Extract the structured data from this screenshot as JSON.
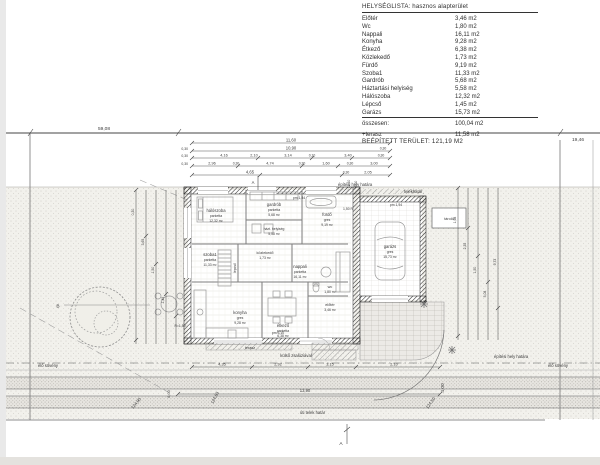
{
  "title_block": {
    "list_title": "HELYSÉGLISTA:  hasznos alapterület",
    "rows": [
      {
        "label": "Előtér",
        "value": "3,46 m2"
      },
      {
        "label": "Wc",
        "value": "1,80 m2"
      },
      {
        "label": "Nappali",
        "value": "16,11 m2"
      },
      {
        "label": "Konyha",
        "value": "9,28 m2"
      },
      {
        "label": "Étkező",
        "value": "6,38 m2"
      },
      {
        "label": "Közlekedő",
        "value": "1,73 m2"
      },
      {
        "label": "Fürdő",
        "value": "9,19 m2"
      },
      {
        "label": "Szoba1",
        "value": "11,33 m2"
      },
      {
        "label": "Gardrób",
        "value": "5,68 m2"
      },
      {
        "label": "Háztartási helyiség",
        "value": "5,58 m2"
      },
      {
        "label": "Hálószoba",
        "value": "12,32 m2"
      },
      {
        "label": "Lépcső",
        "value": "1,45 m2"
      },
      {
        "label": "Garázs",
        "value": "15,73 m2"
      }
    ],
    "total_label": "összesen:",
    "total_value": "100,04 m2",
    "terrace_label": "+terasz",
    "terrace_value": "11,58 m2",
    "built_area": "BEÉPÍTETT TERÜLET: 121,19 M2"
  },
  "rooms": [
    {
      "name": "hálószoba",
      "finish": "parketta",
      "area": "12,32 m²"
    },
    {
      "name": "gardrób",
      "finish": "parketta",
      "area": "5,68 m²"
    },
    {
      "name": "fürdő",
      "finish": "gres",
      "area": "9,19 m²"
    },
    {
      "name": "szoba1",
      "finish": "parketta",
      "area": "11,33 m²"
    },
    {
      "name": "házt. helyiség",
      "finish": "gres",
      "area": "5,58 m²"
    },
    {
      "name": "közlekedő",
      "finish": "parketta",
      "area": "1,73 m²"
    },
    {
      "name": "nappali",
      "finish": "parketta",
      "area": "16,11 m²"
    },
    {
      "name": "konyha",
      "finish": "gres",
      "area": "9,28 m²"
    },
    {
      "name": "étkező",
      "finish": "parketta",
      "area": "6,38 m²"
    },
    {
      "name": "előtér",
      "finish": "gres",
      "area": "3,46 m²"
    },
    {
      "name": "wc",
      "finish": "gres",
      "area": "1,80 m²"
    },
    {
      "name": "garázs",
      "finish": "gres",
      "area": "15,73 m²"
    },
    {
      "name": "terasz"
    },
    {
      "name": "lépcső"
    },
    {
      "name": "tároló"
    }
  ],
  "site_labels": {
    "building_line_top": "építési hely határa",
    "plot_boundary_top": "telekhatár",
    "building_line_right": "építési hely határa",
    "hedge_right": "élő sövény",
    "hedge_left": "élő sövény",
    "street_boundary": "úti telek határ",
    "shutter_note": "külső zsalúziával"
  },
  "dims": {
    "overall_left": "59,08",
    "overall_right": "19,46",
    "top_row1": "11,60",
    "top_row2": [
      "0,30",
      "10,90",
      "0,30"
    ],
    "top_row3": [
      "0,30",
      "4,16",
      "2,10",
      "3,14",
      "0,10",
      "3,40",
      "0,30"
    ],
    "top_row4": [
      "0,30",
      "2,96",
      "0,30",
      "4,74",
      "0,30",
      "1,60",
      "0,30",
      "3,00"
    ],
    "top_row5": [
      "4,65",
      "0,30",
      "2,05"
    ],
    "rot_top": [
      "12,30",
      "6,00"
    ],
    "bottom_row": [
      "4,35",
      "2,92",
      "3,15",
      "2,10"
    ],
    "bottom_width": "13,90",
    "left_chain": [
      "0,30",
      "3,65",
      "1,50",
      "1,45"
    ],
    "right_chain": [
      "1,98",
      "2,35",
      "1,50",
      "5,08",
      "9,73"
    ],
    "front_depth": "4,00",
    "side_depth": "6,00",
    "radius1": "R=1,50",
    "radius2": "1,50 R",
    "pm1": "pm 1,84",
    "pm2": "pm 1,94",
    "pm3": "pm 3,10"
  },
  "spot_heights": [
    "124,90",
    "124,83",
    "124,50"
  ],
  "markers": {
    "section_a": "A",
    "section_b": "B"
  }
}
